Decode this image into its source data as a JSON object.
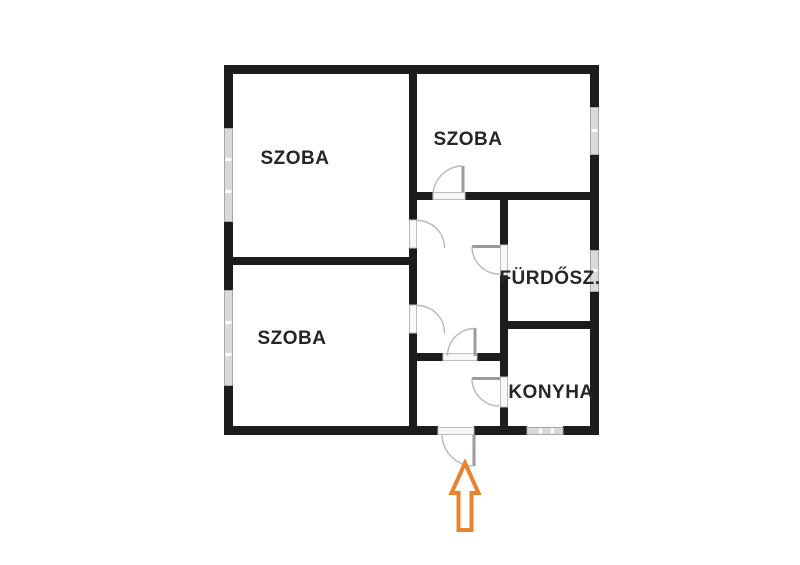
{
  "floorplan": {
    "rooms": [
      {
        "name": "szoba-top-left",
        "label": "SZOBA"
      },
      {
        "name": "szoba-top-right",
        "label": "SZOBA"
      },
      {
        "name": "szoba-bottom-left",
        "label": "SZOBA"
      },
      {
        "name": "bathroom",
        "label": "FÜRDŐSZ."
      },
      {
        "name": "kitchen",
        "label": "KONYHA"
      }
    ],
    "icons": {
      "entrance_arrow": "up-arrow"
    },
    "counts": {
      "windows": 5,
      "doors": 7
    },
    "colors": {
      "wall": "#1c1c1c",
      "door": "#9b9b9b",
      "window_fill": "#d9d9d9",
      "window_border": "#a8a8a8",
      "label": "#262626",
      "arrow": "#e8822c",
      "background": "#ffffff"
    }
  }
}
